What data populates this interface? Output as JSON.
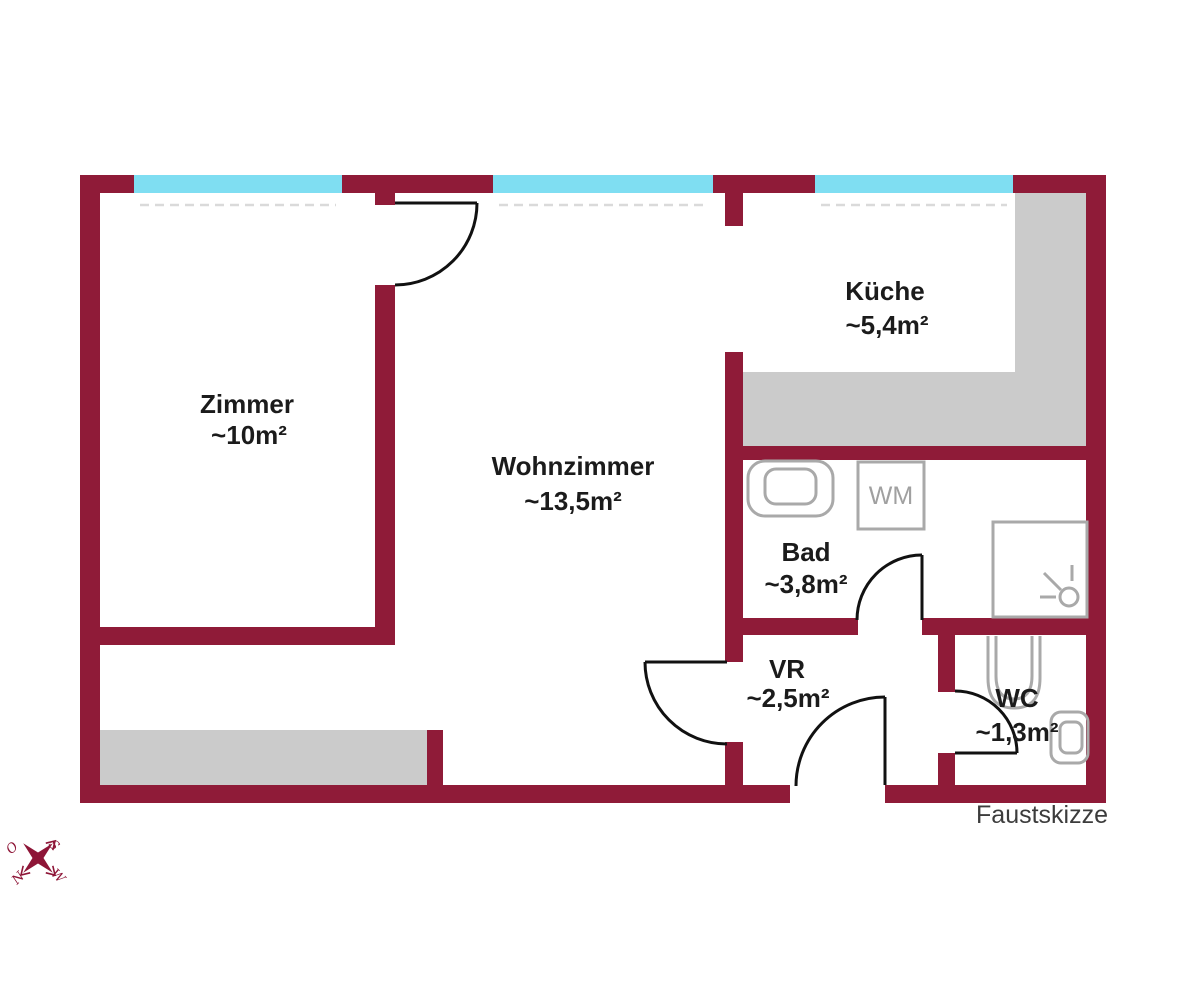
{
  "document": {
    "type_label": "Faustskizze"
  },
  "rooms": [
    {
      "id": "zimmer",
      "name": "Zimmer",
      "area": "~10m²"
    },
    {
      "id": "wohnzimmer",
      "name": "Wohnzimmer",
      "area": "~13,5m²"
    },
    {
      "id": "kueche",
      "name": "Küche",
      "area": "~5,4m²"
    },
    {
      "id": "bad",
      "name": "Bad",
      "area": "~3,8m²"
    },
    {
      "id": "vr",
      "name": "VR",
      "area": "~2,5m²"
    },
    {
      "id": "wc",
      "name": "WC",
      "area": "~1,3m²"
    }
  ],
  "fixtures": {
    "washing_machine_label": "WM"
  },
  "compass": {
    "east": "O",
    "south": "S",
    "north": "N",
    "west": "W"
  },
  "colors": {
    "wall": "#8f1b38",
    "window": "#7fdef2",
    "furniture": "#cbcbcb",
    "fixture_outline": "#a9a9a9",
    "door_arc": "#111111",
    "label_text": "#1b1b1b",
    "compass": "#8e1537"
  }
}
